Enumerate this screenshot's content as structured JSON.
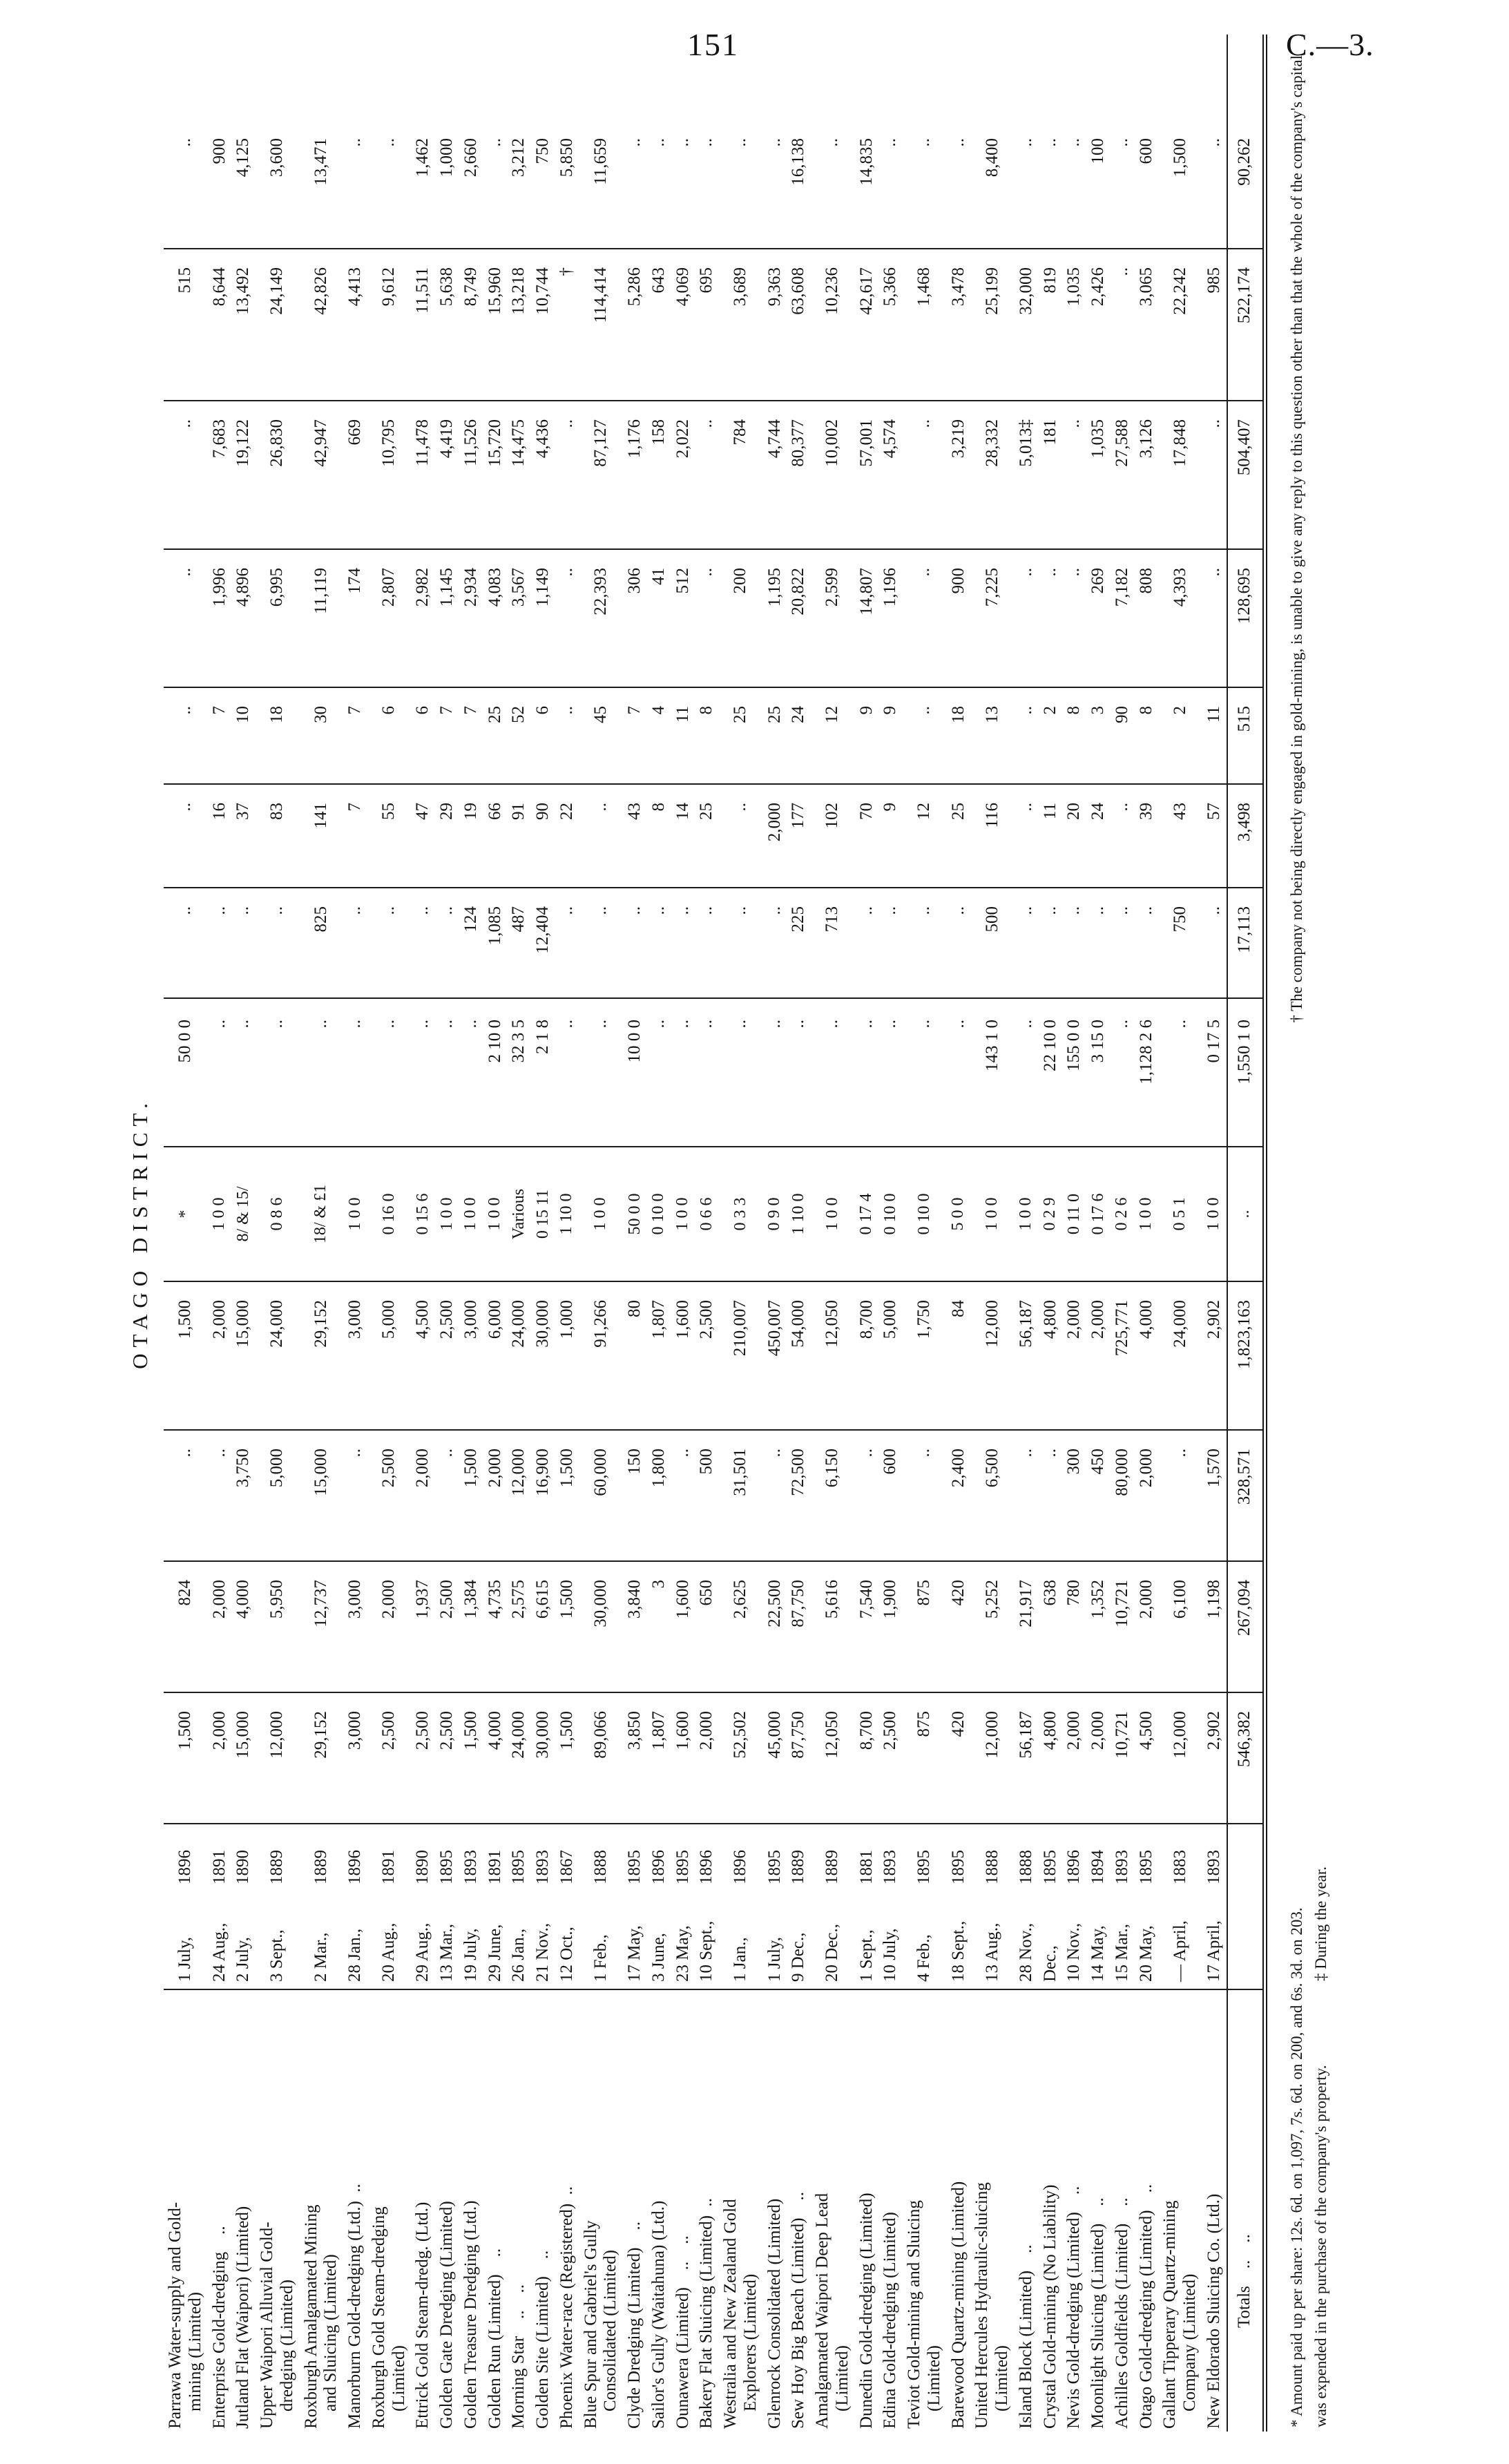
{
  "page": {
    "number": "151",
    "doc_ref": "C.—3."
  },
  "district_heading": "OTAGO DISTRICT.",
  "table": {
    "rows": [
      [
        "Parrawa Water-supply and Gold-\n  mining (Limited)",
        "1 July,",
        "1896",
        "1,500",
        "824",
        "..",
        "1,500",
        "*",
        "50 0 0",
        "..",
        "..",
        "..",
        "..",
        "..",
        "515",
        ".."
      ],
      [
        "Enterprise Gold-dredging  ..",
        "24 Aug.,",
        "1891",
        "2,000",
        "2,000",
        "..",
        "2,000",
        "1 0 0",
        "..",
        "..",
        "16",
        "7",
        "1,996",
        "7,683",
        "8,644",
        "900"
      ],
      [
        "Jutland Flat (Waipori) (Limited)",
        "2 July,",
        "1890",
        "15,000",
        "4,000",
        "3,750",
        "15,000",
        "8/ & 15/",
        "..",
        "..",
        "37",
        "10",
        "4,896",
        "19,122",
        "13,492",
        "4,125"
      ],
      [
        "Upper Waipori Alluvial Gold-\n  dredging (Limited)",
        "3 Sept.,",
        "1889",
        "12,000",
        "5,950",
        "5,000",
        "24,000",
        "0 8 6",
        "..",
        "..",
        "83",
        "18",
        "6,995",
        "26,830",
        "24,149",
        "3,600"
      ],
      [
        "Roxburgh Amalgamated Mining\n  and Sluicing (Limited)",
        "2 Mar.,",
        "1889",
        "29,152",
        "12,737",
        "15,000",
        "29,152",
        "18/ & £1",
        "..",
        "825",
        "141",
        "30",
        "11,119",
        "42,947",
        "42,826",
        "13,471"
      ],
      [
        "Manorburn Gold-dredging (Ltd.) ..",
        "28 Jan.,",
        "1896",
        "3,000",
        "3,000",
        "..",
        "3,000",
        "1 0 0",
        "..",
        "..",
        "7",
        "7",
        "174",
        "669",
        "4,413",
        ".."
      ],
      [
        "Roxburgh Gold Steam-dredging\n  (Limited)",
        "20 Aug.,",
        "1891",
        "2,500",
        "2,000",
        "2,500",
        "5,000",
        "0 16 0",
        "..",
        "..",
        "55",
        "6",
        "2,807",
        "10,795",
        "9,612",
        ".."
      ],
      [
        "Ettrick Gold Steam-dredg. (Ltd.)",
        "29 Aug.,",
        "1890",
        "2,500",
        "1,937",
        "2,000",
        "4,500",
        "0 15 6",
        "..",
        "..",
        "47",
        "6",
        "2,982",
        "11,478",
        "11,511",
        "1,462"
      ],
      [
        "Golden Gate Dredging (Limited)",
        "13 Mar.,",
        "1895",
        "2,500",
        "2,500",
        "..",
        "2,500",
        "1 0 0",
        "..",
        "..",
        "29",
        "7",
        "1,145",
        "4,419",
        "5,638",
        "1,000"
      ],
      [
        "Golden Treasure Dredging (Ltd.)",
        "19 July,",
        "1893",
        "1,500",
        "1,384",
        "1,500",
        "3,000",
        "1 0 0",
        "..",
        "124",
        "19",
        "7",
        "2,934",
        "11,526",
        "8,749",
        "2,660"
      ],
      [
        "Golden Run (Limited)  ..",
        "29 June,",
        "1891",
        "4,000",
        "4,735",
        "2,000",
        "6,000",
        "1 0 0",
        "2 10 0",
        "1,085",
        "66",
        "25",
        "4,083",
        "15,720",
        "15,960",
        ".."
      ],
      [
        "Morning Star  ..  ..",
        "26 Jan.,",
        "1895",
        "24,000",
        "2,575",
        "12,000",
        "24,000",
        "Various",
        "32 3 5",
        "487",
        "91",
        "52",
        "3,567",
        "14,475",
        "13,218",
        "3,212"
      ],
      [
        "Golden Site (Limited)  ..",
        "21 Nov.,",
        "1893",
        "30,000",
        "6,615",
        "16,900",
        "30,000",
        "0 15 11",
        "2 1 8",
        "12,404",
        "90",
        "6",
        "1,149",
        "4,436",
        "10,744",
        "750"
      ],
      [
        "Phoenix Water-race (Registered) ..",
        "12 Oct.,",
        "1867",
        "1,500",
        "1,500",
        "1,500",
        "1,000",
        "1 10 0",
        "..",
        "..",
        "22",
        "..",
        "..",
        "..",
        "†",
        "5,850"
      ],
      [
        "Blue Spur and Gabriel's Gully\n  Consolidated (Limited)",
        "1 Feb.,",
        "1888",
        "89,066",
        "30,000",
        "60,000",
        "91,266",
        "1 0 0",
        "..",
        "..",
        "..",
        "45",
        "22,393",
        "87,127",
        "114,414",
        "11,659"
      ],
      [
        "Clyde Dredging (Limited)  ..",
        "17 May,",
        "1895",
        "3,850",
        "3,840",
        "150",
        "80",
        "50 0 0",
        "10 0 0",
        "..",
        "43",
        "7",
        "306",
        "1,176",
        "5,286",
        ".."
      ],
      [
        "Sailor's Gully (Waitahuna) (Ltd.)",
        "3 June,",
        "1896",
        "1,807",
        "3",
        "1,800",
        "1,807",
        "0 10 0",
        "..",
        "..",
        "8",
        "4",
        "41",
        "158",
        "643",
        ".."
      ],
      [
        "Ounawera (Limited)  ..  ..",
        "23 May,",
        "1895",
        "1,600",
        "1,600",
        "..",
        "1,600",
        "1 0 0",
        "..",
        "..",
        "14",
        "11",
        "512",
        "2,022",
        "4,069",
        ".."
      ],
      [
        "Bakery Flat Sluicing (Limited) ..",
        "10 Sept.,",
        "1896",
        "2,000",
        "650",
        "500",
        "2,500",
        "0 6 6",
        "..",
        "..",
        "25",
        "8",
        "..",
        "..",
        "695",
        ".."
      ],
      [
        "Westralia and New Zealand Gold\n  Explorers (Limited)",
        "1 Jan.,",
        "1896",
        "52,502",
        "2,625",
        "31,501",
        "210,007",
        "0 3 3",
        "..",
        "..",
        "..",
        "25",
        "200",
        "784",
        "3,689",
        ".."
      ],
      [
        "Glenrock Consolidated (Limited)",
        "1 July,",
        "1895",
        "45,000",
        "22,500",
        "..",
        "450,007",
        "0 9 0",
        "..",
        "..",
        "2,000",
        "25",
        "1,195",
        "4,744",
        "9,363",
        ".."
      ],
      [
        "Sew Hoy Big Beach (Limited)  ..",
        "9 Dec.,",
        "1889",
        "87,750",
        "87,750",
        "72,500",
        "54,000",
        "1 10 0",
        "..",
        "225",
        "177",
        "24",
        "20,822",
        "80,377",
        "63,608",
        "16,138"
      ],
      [
        "Amalgamated Waipori Deep Lead\n  (Limited)",
        "20 Dec.,",
        "1889",
        "12,050",
        "5,616",
        "6,150",
        "12,050",
        "1 0 0",
        "..",
        "713",
        "102",
        "12",
        "2,599",
        "10,002",
        "10,236",
        ".."
      ],
      [
        "Dunedin Gold-dredging (Limited)",
        "1 Sept.,",
        "1881",
        "8,700",
        "7,540",
        "..",
        "8,700",
        "0 17 4",
        "..",
        "..",
        "70",
        "9",
        "14,807",
        "57,001",
        "42,617",
        "14,835"
      ],
      [
        "Edina Gold-dredging (Limited)",
        "10 July,",
        "1893",
        "2,500",
        "1,900",
        "600",
        "5,000",
        "0 10 0",
        "..",
        "..",
        "9",
        "9",
        "1,196",
        "4,574",
        "5,366",
        ".."
      ],
      [
        "Teviot Gold-mining and Sluicing\n  (Limited)",
        "4 Feb.,",
        "1895",
        "875",
        "875",
        "..",
        "1,750",
        "0 10 0",
        "..",
        "..",
        "12",
        "..",
        "..",
        "..",
        "1,468",
        ".."
      ],
      [
        "Barewood Quartz-mining (Limited)",
        "18 Sept.,",
        "1895",
        "420",
        "420",
        "2,400",
        "84",
        "5 0 0",
        "..",
        "..",
        "25",
        "18",
        "900",
        "3,219",
        "3,478",
        ".."
      ],
      [
        "United Hercules Hydraulic-sluicing\n  (Limited)",
        "13 Aug.,",
        "1888",
        "12,000",
        "5,252",
        "6,500",
        "12,000",
        "1 0 0",
        "143 1 0",
        "500",
        "116",
        "13",
        "7,225",
        "28,332",
        "25,199",
        "8,400"
      ],
      [
        "Island Block (Limited)  ..",
        "28 Nov.,",
        "1888",
        "56,187",
        "21,917",
        "..",
        "56,187",
        "1 0 0",
        "..",
        "..",
        "..",
        "..",
        "..",
        "5,013‡",
        "32,000",
        ".."
      ],
      [
        "Crystal Gold-mining (No Liability)",
        "Dec.,",
        "1895",
        "4,800",
        "638",
        "..",
        "4,800",
        "0 2 9",
        "22 10 0",
        "..",
        "11",
        "2",
        "..",
        "181",
        "819",
        ".."
      ],
      [
        "Nevis Gold-dredging (Limited)  ..",
        "10 Nov.,",
        "1896",
        "2,000",
        "780",
        "300",
        "2,000",
        "0 11 0",
        "155 0 0",
        "..",
        "20",
        "8",
        "..",
        "..",
        "1,035",
        ".."
      ],
      [
        "Moonlight Sluicing (Limited)  ..",
        "14 May,",
        "1894",
        "2,000",
        "1,352",
        "450",
        "2,000",
        "0 17 6",
        "3 15 0",
        "..",
        "24",
        "3",
        "269",
        "1,035",
        "2,426",
        "100"
      ],
      [
        "Achilles Goldfields (Limited)  ..",
        "15 Mar.,",
        "1893",
        "10,721",
        "10,721",
        "80,000",
        "725,771",
        "0 2 6",
        "..",
        "..",
        "..",
        "90",
        "7,182",
        "27,588",
        "..",
        ".."
      ],
      [
        "Otago Gold-dredging (Limited)  ..",
        "20 May,",
        "1895",
        "4,500",
        "2,000",
        "2,000",
        "4,000",
        "1 0 0",
        "1,128 2 6",
        "..",
        "39",
        "8",
        "808",
        "3,126",
        "3,065",
        "600"
      ],
      [
        "Gallant Tipperary Quartz-mining\n  Company (Limited)",
        "— April,",
        "1883",
        "12,000",
        "6,100",
        "..",
        "24,000",
        "0 5 1",
        "..",
        "750",
        "43",
        "2",
        "4,393",
        "17,848",
        "22,242",
        "1,500"
      ],
      [
        "New Eldorado Sluicing Co. (Ltd.)",
        "17 April,",
        "1893",
        "2,902",
        "1,198",
        "1,570",
        "2,902",
        "1 0 0",
        "0 17 5",
        "..",
        "57",
        "11",
        "..",
        "..",
        "985",
        ".."
      ]
    ],
    "totals": [
      "Totals  ..  ..",
      "",
      "",
      "546,382",
      "267,094",
      "328,571",
      "1,823,163",
      "..",
      "1,550 1 0",
      "17,113",
      "3,498",
      "515",
      "128,695",
      "504,407",
      "522,174",
      "90,262"
    ]
  },
  "footnotes": {
    "line1_left": "* Amount paid up per share: 12s. 6d. on 1,097, 7s. 6d. on 200, and 6s. 3d. on 203.",
    "line1_right": "† The company not being directly engaged in gold-mining, is unable to give any reply to this question other than that the whole of the company's capital",
    "line2_left": "was expended in the purchase of the company's property.",
    "line2_right": "‡ During the year."
  }
}
